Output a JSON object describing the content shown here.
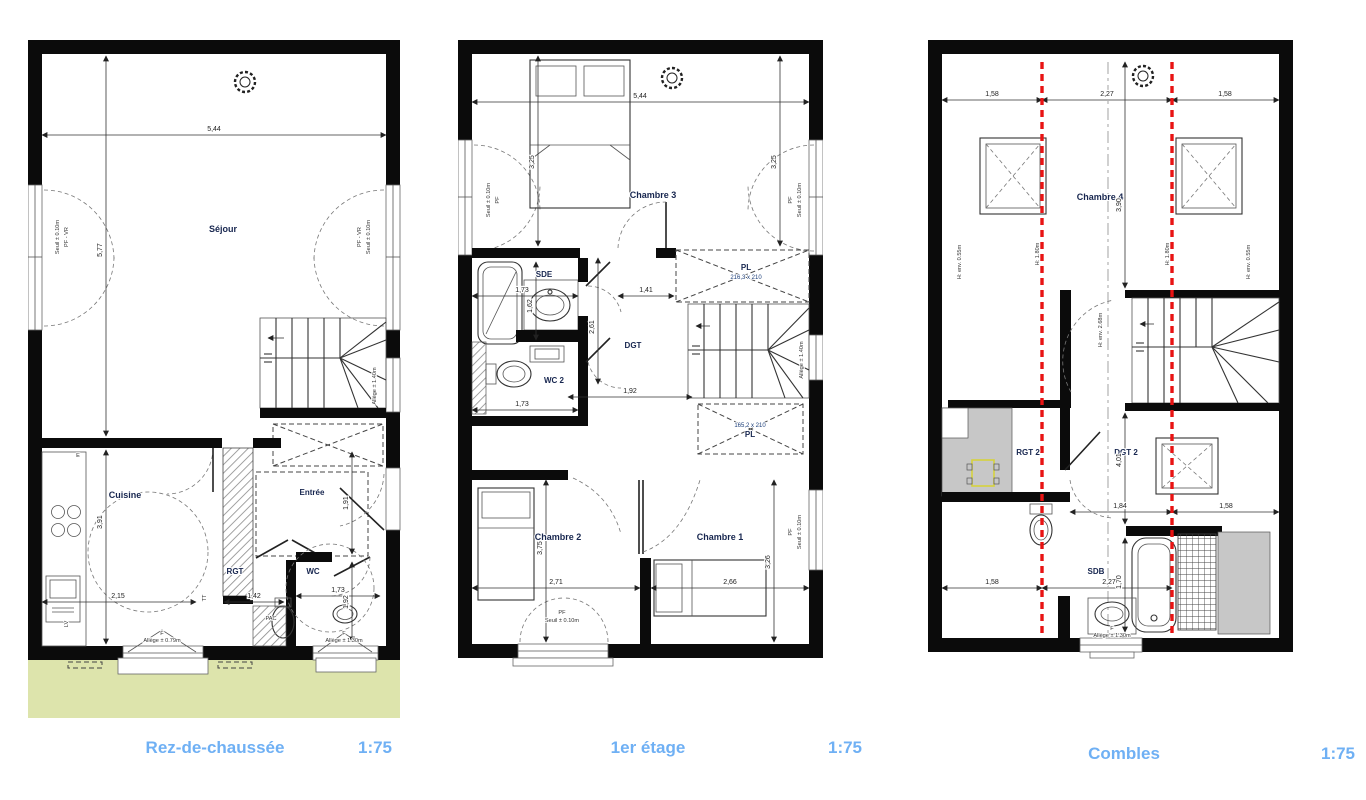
{
  "titles": {
    "rdc": {
      "name": "Rez-de-chaussée",
      "scale": "1:75"
    },
    "etage1": {
      "name": "1er étage",
      "scale": "1:75"
    },
    "combles": {
      "name": "Combles",
      "scale": "1:75"
    }
  },
  "colors": {
    "title_blue": "#6fb0f4",
    "wall_black": "#0b0b0b",
    "garden_green": "#dde4ac",
    "height_limit_red": "#e81313",
    "attic_gray": "#c7c7c7"
  },
  "rdc": {
    "rooms": {
      "sejour": "Séjour",
      "cuisine": "Cuisine",
      "entree": "Entrée",
      "rgt": "RGT",
      "wc": "WC",
      "pac": "PAC"
    },
    "dims": {
      "d544": "5,44",
      "d577": "5,77",
      "d391": "3,91",
      "d215": "2,15",
      "d142": "1,42",
      "d173": "1,73",
      "d192": "1,92",
      "d191": "1,91"
    },
    "ann": {
      "pfvr": "PF - VR",
      "seuil": "Seuil ± 0.10m",
      "f": "F",
      "allege079": "Allège ± 0.79m",
      "allege130": "Allège ± 1.30m",
      "lv": "LV",
      "tt": "TT",
      "e": "E",
      "allege_stair": "Allège ± 1.40m"
    }
  },
  "etage1": {
    "rooms": {
      "ch3": "Chambre 3",
      "sde": "SDE",
      "wc2": "WC 2",
      "dgt": "DGT",
      "ch2": "Chambre 2",
      "ch1": "Chambre 1",
      "pl": "PL"
    },
    "dims": {
      "d544": "5,44",
      "d325": "3,25",
      "d173": "1,73",
      "d141": "1,41",
      "d162": "1,62",
      "d261": "2,61",
      "d192": "1,92",
      "d271": "2,71",
      "d266": "2,66",
      "d375": "3,75",
      "d326": "3,26"
    },
    "ann": {
      "pl1size": "216,3 x 210",
      "pl2size": "165,2 x 210",
      "pf": "PF",
      "seuil": "Seuil ± 0.10m",
      "allege_stair": "Allège ± 1.40m"
    }
  },
  "combles": {
    "rooms": {
      "ch4": "Chambre 4",
      "rgt2": "RGT 2",
      "dgt2": "DGT 2",
      "sdb": "SDB"
    },
    "dims": {
      "d158": "1,58",
      "d227": "2,27",
      "d390": "3,90",
      "d401": "4,01",
      "d184": "1,84",
      "d170": "1,70"
    },
    "ann": {
      "h055": "H: env. 0.55m",
      "h180": "H: 1.80m",
      "h268": "H: env. 2.68m",
      "f": "F",
      "allege130": "Allège ± 1.30m"
    }
  }
}
